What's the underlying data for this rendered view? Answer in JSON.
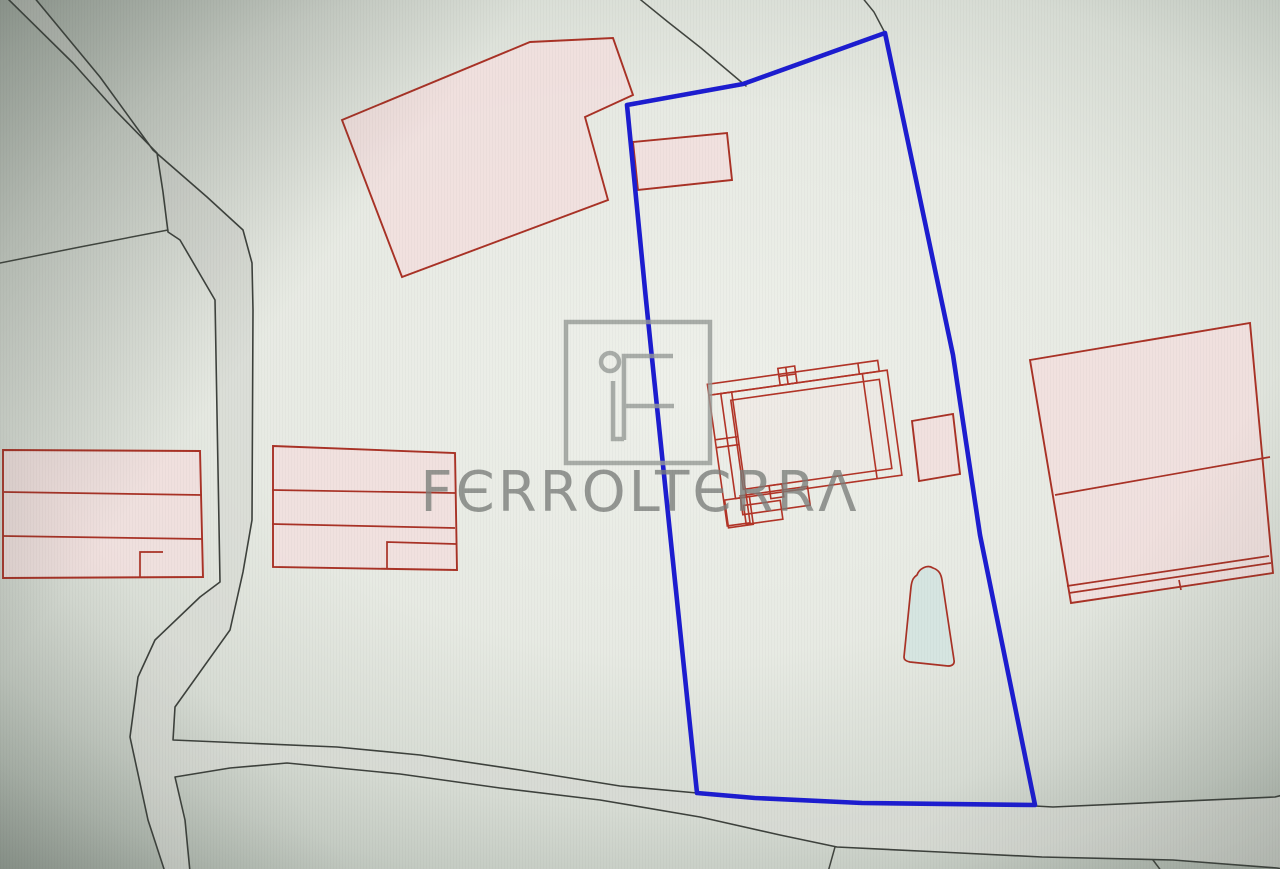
{
  "watermark": {
    "brand_text": "FERROLTERRA",
    "display_text": "FЄRROLTЄRRΛ",
    "logo_monogram": "iF"
  },
  "colors": {
    "parcel_outline_red": "#a93226",
    "parcel_fill_pink": "#f1dfde",
    "selected_boundary_blue": "#1d1dd0",
    "road_fill": "#d8dbd4",
    "road_edge": "#3d413c",
    "background_center": "#eef0ea",
    "background_corner": "#9aa39a",
    "pool_fill": "#d6e5e1",
    "watermark_gray": "#8f938f"
  },
  "map": {
    "shapes": [
      {
        "tag": "path",
        "name": "road-network",
        "interactable": false,
        "attrs": {
          "class": "road",
          "d": "M5,-4 L33,-4 L100,77 L153,150 L207,197 L243,230 L252,263 L253,310 L252,520 L243,572 L230,630 L175,707 L173,740 L337,747 L420,755 L520,770 L620,786 L697,793 L755,798 L862,803 L1035,806 L1053,807 L1275,797 L1283,795 L1283,869 L1277,868 L1173,860 L1042,857 L940,852 L837,847 L780,835 L700,817 L600,800 L500,788 L400,774 L287,763 L230,768 L175,777 L185,820 L190,872 L165,872 L148,820 L130,737 L138,677 L155,640 L200,597 L220,582 L215,300 L180,240 L168,232 L163,192 L157,153 L115,110 L73,63 Z"
        }
      },
      {
        "tag": "path",
        "name": "parcel-line-left",
        "interactable": false,
        "attrs": {
          "class": "dark",
          "d": "M0,263 L80,247 L168,230"
        }
      },
      {
        "tag": "path",
        "name": "parcel-line-top-center",
        "interactable": false,
        "attrs": {
          "class": "dark",
          "d": "M636,-4 L668,22 L701,48 L746,86"
        }
      },
      {
        "tag": "path",
        "name": "parcel-line-top-right",
        "interactable": false,
        "attrs": {
          "class": "dark",
          "d": "M861,-4 L874,12 L885,33"
        }
      },
      {
        "tag": "path",
        "name": "parcel-line-bottom-center",
        "interactable": false,
        "attrs": {
          "class": "dark",
          "d": "M835,847 L828,872"
        }
      },
      {
        "tag": "path",
        "name": "parcel-line-bottom-right",
        "interactable": false,
        "attrs": {
          "class": "dark",
          "d": "M1153,860 L1162,872"
        }
      },
      {
        "tag": "polygon",
        "name": "building-top-left",
        "interactable": false,
        "attrs": {
          "class": "bld",
          "points": "342,120 530,42 613,38 633,95 585,117 608,200 402,277"
        }
      },
      {
        "tag": "polygon",
        "name": "building-inside-boundary-top",
        "interactable": false,
        "attrs": {
          "class": "bld",
          "points": "633,142 727,133 732,180 638,190"
        }
      },
      {
        "tag": "polygon",
        "name": "building-group-left-outer",
        "interactable": false,
        "attrs": {
          "class": "bld",
          "points": "3,450 200,451 203,577 3,578"
        }
      },
      {
        "tag": "path",
        "name": "building-group-left-dividers",
        "interactable": false,
        "attrs": {
          "class": "bldline",
          "d": "M4,492 L202,495 M3,536 L203,539 M140,577 L140,552 L163,552"
        }
      },
      {
        "tag": "polygon",
        "name": "building-group-center-outer",
        "interactable": false,
        "attrs": {
          "class": "bld",
          "points": "273,446 455,453 457,570 273,567"
        }
      },
      {
        "tag": "path",
        "name": "building-group-center-dividers",
        "interactable": false,
        "attrs": {
          "class": "bldline",
          "d": "M272,490 L455,493 M272,524 L455,528 M387,569 L387,542 L456,544"
        }
      },
      {
        "tag": "polygon",
        "name": "building-right-outer",
        "interactable": false,
        "attrs": {
          "class": "bld",
          "points": "1030,360 1250,323 1273,573 1071,603"
        }
      },
      {
        "tag": "path",
        "name": "building-right-dividers",
        "interactable": false,
        "attrs": {
          "class": "bldline",
          "d": "M1055,495 L1270,457 M1069,593 L1271,563 M1067,586 L1269,556 M1179,580 L1181,590"
        }
      },
      {
        "tag": "g",
        "name": "building-cluster-center",
        "interactable": false,
        "attrs": {
          "transform": "rotate(-8 800 440)"
        },
        "children": [
          {
            "tag": "rect",
            "name": "cluster-top-strip",
            "interactable": false,
            "attrs": {
              "class": "clu",
              "x": "716",
              "y": "372",
              "width": "172",
              "height": "11"
            }
          },
          {
            "tag": "path",
            "name": "cluster-strip-divider",
            "interactable": false,
            "attrs": {
              "class": "clu",
              "d": "M868,372 L868,383"
            }
          },
          {
            "tag": "rect",
            "name": "cluster-cross-box",
            "interactable": false,
            "attrs": {
              "class": "clu",
              "x": "788",
              "y": "366",
              "width": "17",
              "height": "17"
            }
          },
          {
            "tag": "path",
            "name": "cluster-cross-lines",
            "interactable": false,
            "attrs": {
              "class": "clu",
              "d": "M788,374 L805,374 M796,366 L796,383"
            }
          },
          {
            "tag": "rect",
            "name": "cluster-outer-rect",
            "interactable": false,
            "attrs": {
              "class": "clu",
              "x": "728",
              "y": "383",
              "width": "168",
              "height": "106"
            }
          },
          {
            "tag": "rect",
            "name": "cluster-inner-rect",
            "interactable": false,
            "attrs": {
              "class": "clufill",
              "x": "737",
              "y": "391",
              "width": "150",
              "height": "90"
            }
          },
          {
            "tag": "rect",
            "name": "cluster-left-column",
            "interactable": false,
            "attrs": {
              "class": "clu",
              "x": "716",
              "y": "383",
              "width": "23",
              "height": "132"
            }
          },
          {
            "tag": "path",
            "name": "cluster-left-column-dividers",
            "interactable": false,
            "attrs": {
              "class": "clu",
              "d": "M716,428 L739,428 M716,436 L739,436"
            }
          },
          {
            "tag": "rect",
            "name": "cluster-left-annex",
            "interactable": false,
            "attrs": {
              "class": "clu",
              "x": "717",
              "y": "489",
              "width": "25",
              "height": "28"
            }
          },
          {
            "tag": "rect",
            "name": "cluster-bottom-rect",
            "interactable": false,
            "attrs": {
              "class": "clu",
              "x": "733",
              "y": "487",
              "width": "68",
              "height": "19"
            }
          },
          {
            "tag": "rect",
            "name": "cluster-bottom-small",
            "interactable": false,
            "attrs": {
              "class": "clu",
              "x": "735",
              "y": "497",
              "width": "37",
              "height": "19"
            }
          },
          {
            "tag": "rect",
            "name": "cluster-tiny-rect",
            "interactable": false,
            "attrs": {
              "class": "clu",
              "x": "763",
              "y": "481",
              "width": "13",
              "height": "13"
            }
          },
          {
            "tag": "path",
            "name": "cluster-right-divider",
            "interactable": false,
            "attrs": {
              "class": "clu",
              "d": "M871,383 L871,489"
            }
          }
        ]
      },
      {
        "tag": "polygon",
        "name": "building-small-annex",
        "interactable": false,
        "attrs": {
          "class": "bld",
          "points": "912,421 953,414 960,474 919,481"
        }
      },
      {
        "tag": "path",
        "name": "pool",
        "interactable": false,
        "attrs": {
          "class": "pool",
          "d": "M904,657 L911,587 C912,579 914,577 917,575 C919,569 927,564 933,568 C939,570 941,574 942,580 L954,660 C955,665 951,666 948,666 L910,662 C906,661 904,660 904,657 Z"
        }
      },
      {
        "tag": "path",
        "name": "selected-parcel-boundary",
        "interactable": true,
        "attrs": {
          "class": "blue",
          "d": "M627,105 L743,84 L885,33 L953,355 L980,535 L1035,805 L862,803 L755,798 L697,793 L670,533 L646,300 Z"
        }
      }
    ]
  }
}
